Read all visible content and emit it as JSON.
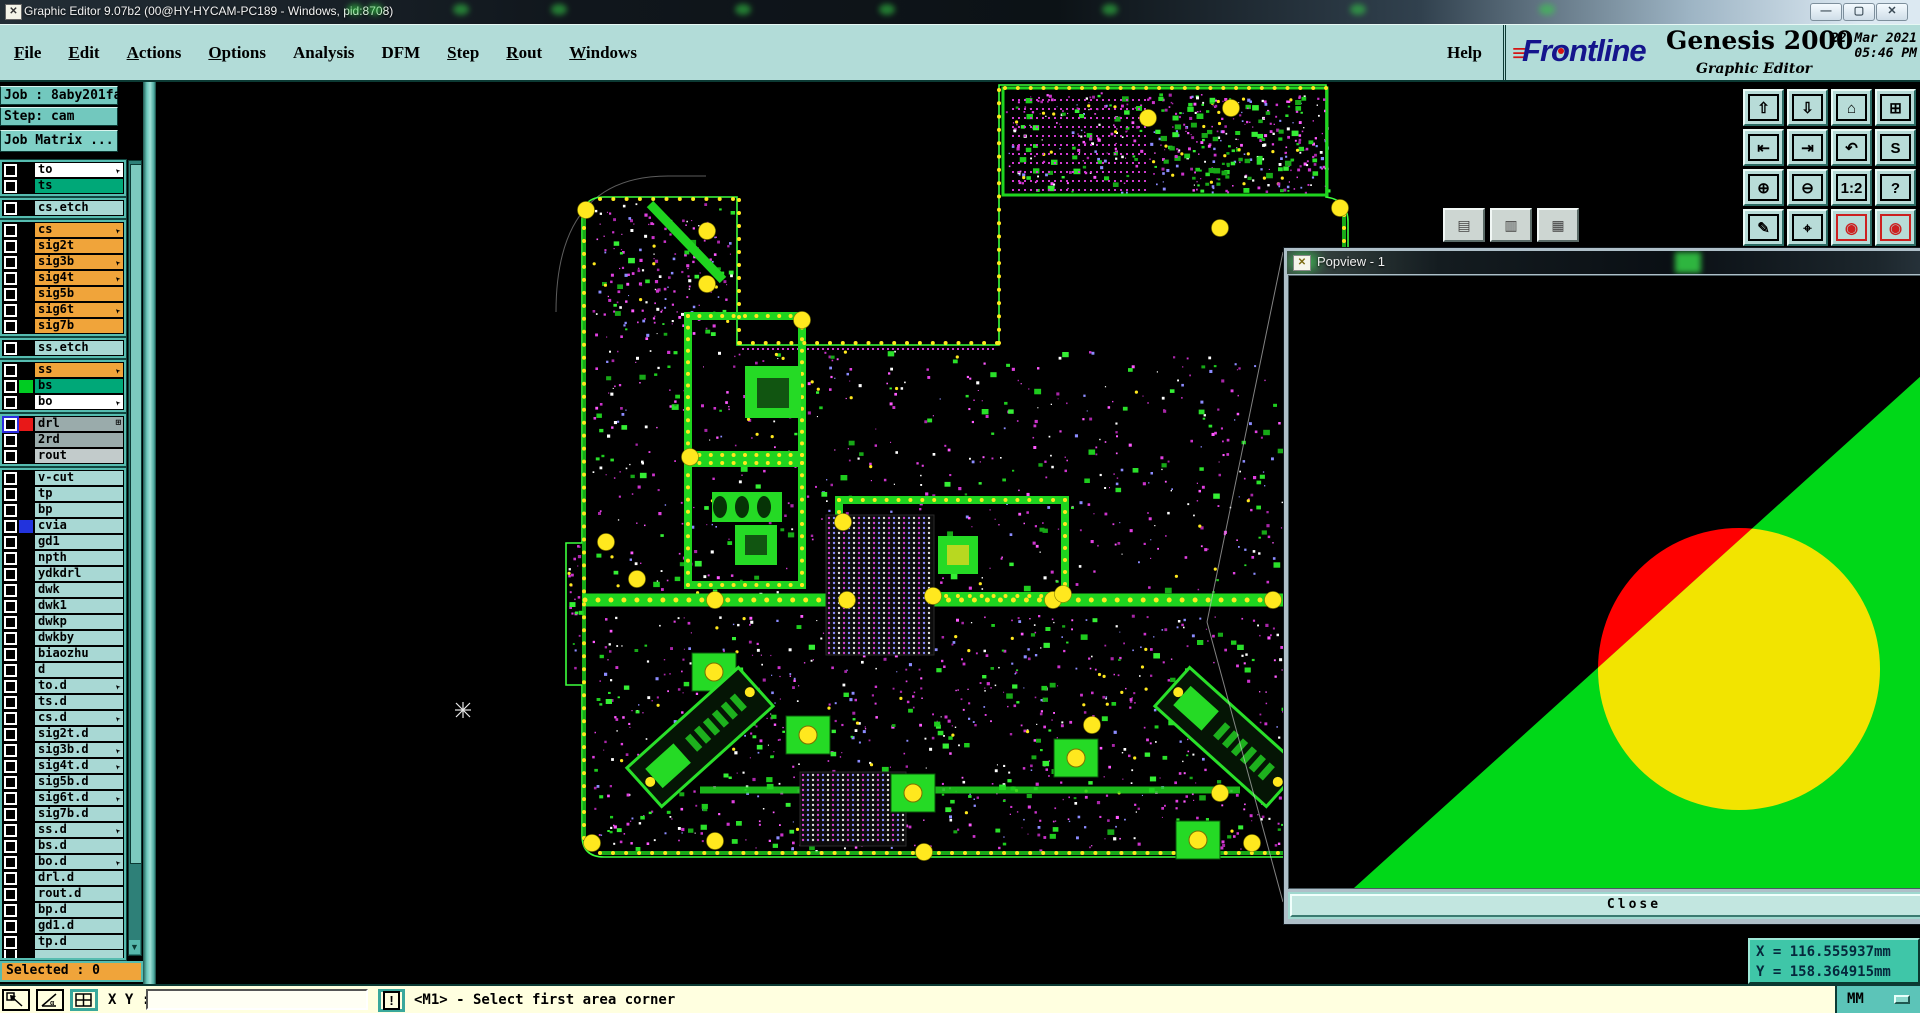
{
  "window": {
    "title": "Graphic Editor 9.07b2 (00@HY-HYCAM-PC189 - Windows, pid:8708)",
    "controls": [
      {
        "name": "minimize-button",
        "glyph": "—"
      },
      {
        "name": "maximize-button",
        "glyph": "▢"
      },
      {
        "name": "close-button",
        "glyph": "✕"
      }
    ]
  },
  "menu": {
    "items": [
      {
        "label": "File",
        "u": 0
      },
      {
        "label": "Edit",
        "u": 0
      },
      {
        "label": "Actions",
        "u": 0
      },
      {
        "label": "Options",
        "u": 0
      },
      {
        "label": "Analysis",
        "u": -1
      },
      {
        "label": "DFM",
        "u": -1
      },
      {
        "label": "Step",
        "u": 0
      },
      {
        "label": "Rout",
        "u": 0
      },
      {
        "label": "Windows",
        "u": 0
      }
    ],
    "help": "Help"
  },
  "brand": {
    "logo": "Frontline",
    "product": "Genesis 2000",
    "subtitle": "Graphic Editor",
    "date": "22 Mar 2021",
    "time": "05:46 PM"
  },
  "job": {
    "job_label": "Job : 8aby201fa0",
    "step_label": "Step: cam",
    "matrix_label": "Job Matrix ..."
  },
  "layers": {
    "groups": [
      [
        {
          "name": "to",
          "bg": "#ffffff",
          "marker": "arrow"
        },
        {
          "name": "ts",
          "bg": "#00a878"
        }
      ],
      [
        {
          "name": "cs.etch",
          "bg": "#a8d8d4"
        }
      ],
      [
        {
          "name": "cs",
          "bg": "#f0a43a",
          "marker": "arrow"
        },
        {
          "name": "sig2t",
          "bg": "#f0a43a"
        },
        {
          "name": "sig3b",
          "bg": "#f0a43a",
          "marker": "arrow"
        },
        {
          "name": "sig4t",
          "bg": "#f0a43a",
          "marker": "arrow"
        },
        {
          "name": "sig5b",
          "bg": "#f0a43a"
        },
        {
          "name": "sig6t",
          "bg": "#f0a43a",
          "marker": "arrow"
        },
        {
          "name": "sig7b",
          "bg": "#f0a43a"
        }
      ],
      [
        {
          "name": "ss.etch",
          "bg": "#a8d8d4"
        }
      ],
      [
        {
          "name": "ss",
          "bg": "#f0a43a",
          "marker": "arrow"
        },
        {
          "name": "bs",
          "bg": "#00a878",
          "swatch": "#00cc22"
        },
        {
          "name": "bo",
          "bg": "#ffffff",
          "marker": "arrow"
        }
      ],
      [
        {
          "name": "drl",
          "bg": "#9aabab",
          "swatch": "#e81818",
          "marker": "plus",
          "blue": true
        },
        {
          "name": "2rd",
          "bg": "#9aabab"
        },
        {
          "name": "rout",
          "bg": "#c2cbcb"
        }
      ],
      [
        {
          "name": "v-cut",
          "bg": "#a8d8d4"
        },
        {
          "name": "tp",
          "bg": "#a8d8d4"
        },
        {
          "name": "bp",
          "bg": "#a8d8d4"
        },
        {
          "name": "cvia",
          "bg": "#a8d8d4",
          "swatch": "#2233dd"
        },
        {
          "name": "gd1",
          "bg": "#a8d8d4"
        },
        {
          "name": "npth",
          "bg": "#a8d8d4"
        },
        {
          "name": "ydkdrl",
          "bg": "#a8d8d4"
        },
        {
          "name": "dwk",
          "bg": "#a8d8d4"
        },
        {
          "name": "dwk1",
          "bg": "#a8d8d4"
        },
        {
          "name": "dwkp",
          "bg": "#a8d8d4"
        },
        {
          "name": "dwkby",
          "bg": "#a8d8d4"
        },
        {
          "name": "biaozhu",
          "bg": "#a8d8d4"
        },
        {
          "name": "d",
          "bg": "#a8d8d4"
        },
        {
          "name": "to.d",
          "bg": "#a8d8d4",
          "marker": "arrow"
        },
        {
          "name": "ts.d",
          "bg": "#a8d8d4"
        },
        {
          "name": "cs.d",
          "bg": "#a8d8d4",
          "marker": "arrow"
        },
        {
          "name": "sig2t.d",
          "bg": "#a8d8d4"
        },
        {
          "name": "sig3b.d",
          "bg": "#a8d8d4",
          "marker": "arrow"
        },
        {
          "name": "sig4t.d",
          "bg": "#a8d8d4",
          "marker": "arrow"
        },
        {
          "name": "sig5b.d",
          "bg": "#a8d8d4"
        },
        {
          "name": "sig6t.d",
          "bg": "#a8d8d4",
          "marker": "arrow"
        },
        {
          "name": "sig7b.d",
          "bg": "#a8d8d4"
        },
        {
          "name": "ss.d",
          "bg": "#a8d8d4",
          "marker": "arrow"
        },
        {
          "name": "bs.d",
          "bg": "#a8d8d4"
        },
        {
          "name": "bo.d",
          "bg": "#a8d8d4",
          "marker": "arrow"
        },
        {
          "name": "drl.d",
          "bg": "#a8d8d4"
        },
        {
          "name": "rout.d",
          "bg": "#a8d8d4"
        },
        {
          "name": "bp.d",
          "bg": "#a8d8d4"
        },
        {
          "name": "gd1.d",
          "bg": "#a8d8d4"
        },
        {
          "name": "tp.d",
          "bg": "#a8d8d4"
        },
        {
          "name": "",
          "bg": "#a8d8d4",
          "partial": true
        }
      ]
    ]
  },
  "selected_text": "Selected : 0",
  "right_toolbar": [
    {
      "name": "zoom-in-button",
      "glyph": "⇧"
    },
    {
      "name": "zoom-out-button",
      "glyph": "⇩"
    },
    {
      "name": "home-view-button",
      "glyph": "⌂"
    },
    {
      "name": "tile-windows-button",
      "glyph": "⊞"
    },
    {
      "name": "pan-left-button",
      "glyph": "⇤"
    },
    {
      "name": "pan-right-button",
      "glyph": "⇥"
    },
    {
      "name": "undo-view-button",
      "glyph": "↶"
    },
    {
      "name": "serpentine-button",
      "glyph": "S"
    },
    {
      "name": "zoom-fit-button",
      "glyph": "⊕"
    },
    {
      "name": "zoom-center-button",
      "glyph": "⊖"
    },
    {
      "name": "scale-1-2-button",
      "glyph": "1:2"
    },
    {
      "name": "help-query-button",
      "glyph": "?"
    },
    {
      "name": "setup-tools-button",
      "glyph": "✎"
    },
    {
      "name": "probe-button",
      "glyph": "⌖"
    },
    {
      "name": "netlist-a-button",
      "glyph": "◉",
      "red": true
    },
    {
      "name": "netlist-b-button",
      "glyph": "◉",
      "red": true
    }
  ],
  "floating_buttons": [
    {
      "name": "panel-button-1",
      "glyph": "▤"
    },
    {
      "name": "panel-button-2",
      "glyph": "▥"
    },
    {
      "name": "panel-button-3",
      "glyph": "▦"
    }
  ],
  "popview": {
    "title": "Popview - 1",
    "close_label": "Close",
    "colors": {
      "bg": "#000000",
      "green": "#00d818",
      "yellow": "#f2e400",
      "red": "#ff0000"
    }
  },
  "statusbar": {
    "xy_label": "X Y :",
    "input_value": "",
    "bang": "!",
    "prompt": "<M1> - Select first area corner",
    "units": "MM"
  },
  "coords": {
    "x": "X = 116.555937mm",
    "y": "Y = 158.364915mm"
  },
  "board": {
    "colors": {
      "outline": "#3dff3d",
      "trace": "#1fd41f",
      "bright": "#25da25",
      "pad_yellow": "#ffe81e",
      "magenta": "#dd44dd",
      "profile_white": "#aaaaaa"
    }
  }
}
